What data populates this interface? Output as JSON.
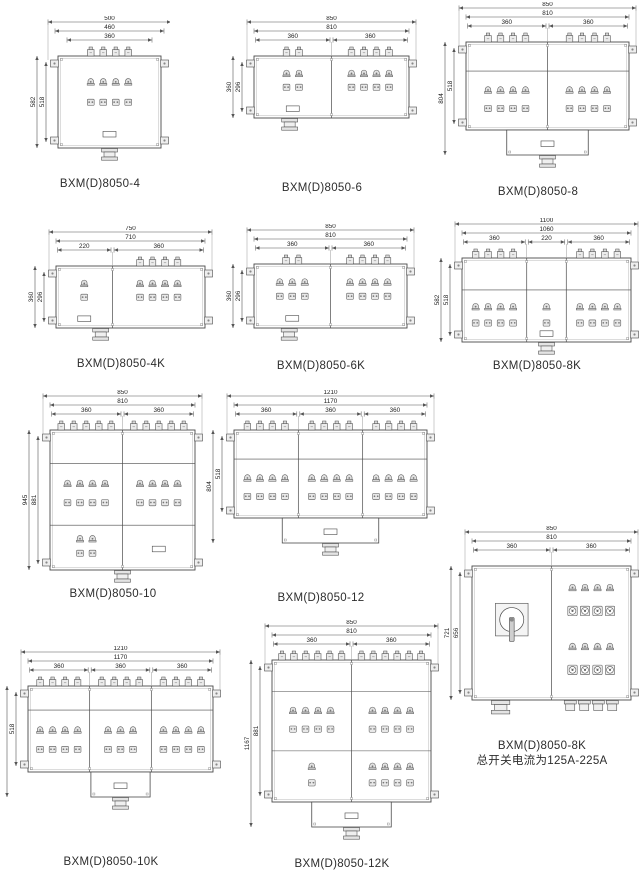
{
  "diagrams": [
    {
      "key": "d4",
      "caption": "BXM(D)8050-4",
      "note": "",
      "top_dims": [
        "500",
        "460",
        "360"
      ],
      "seg_dims": [],
      "side_dims": [
        "582",
        "518"
      ],
      "sections": [
        {
          "breakers": 4,
          "mid": [
            4,
            4
          ]
        }
      ],
      "features": {
        "bands": 0,
        "bottom_box": "none",
        "gland": true,
        "gland_at": "center",
        "nameplate_at": "center"
      }
    },
    {
      "key": "d6",
      "caption": "BXM(D)8050-6",
      "note": "",
      "top_dims": [
        "850",
        "810"
      ],
      "seg_dims": [
        "360",
        "360"
      ],
      "side_dims": [
        "360",
        "296"
      ],
      "sections": [
        {
          "breakers": 2,
          "mid": [
            2,
            2
          ]
        },
        {
          "breakers": 4,
          "mid": [
            4,
            4
          ]
        }
      ],
      "features": {
        "bands": 0,
        "bottom_box": "none",
        "gland": true,
        "gland_at": "left",
        "nameplate_at": "left"
      }
    },
    {
      "key": "d8",
      "caption": "BXM(D)8050-8",
      "note": "",
      "top_dims": [
        "850",
        "810"
      ],
      "seg_dims": [
        "360",
        "360"
      ],
      "side_dims": [
        "804",
        "518"
      ],
      "sections": [
        {
          "breakers": 4,
          "mid": [
            4,
            4
          ]
        },
        {
          "breakers": 4,
          "mid": [
            4,
            4
          ]
        }
      ],
      "features": {
        "bands": 1,
        "bottom_box": "wide",
        "gland": true,
        "gland_at": "center",
        "nameplate_at": "ext"
      }
    },
    {
      "key": "d4k",
      "caption": "BXM(D)8050-4K",
      "note": "",
      "top_dims": [
        "750",
        "710"
      ],
      "seg_dims": [
        "220",
        "360"
      ],
      "side_dims": [
        "360",
        "296"
      ],
      "sections": [
        {
          "breakers": 0,
          "mid": [
            1,
            1
          ]
        },
        {
          "breakers": 4,
          "mid": [
            4,
            4
          ]
        }
      ],
      "features": {
        "bands": 0,
        "bottom_box": "none",
        "gland": true,
        "gland_at": "leftmid",
        "nameplate_at": "left"
      }
    },
    {
      "key": "d6k",
      "caption": "BXM(D)8050-6K",
      "note": "",
      "top_dims": [
        "850",
        "810"
      ],
      "seg_dims": [
        "360",
        "360"
      ],
      "side_dims": [
        "360",
        "296"
      ],
      "sections": [
        {
          "breakers": 2,
          "mid": [
            3,
            3
          ]
        },
        {
          "breakers": 4,
          "mid": [
            4,
            4
          ]
        }
      ],
      "features": {
        "bands": 0,
        "bottom_box": "none",
        "gland": true,
        "gland_at": "left",
        "nameplate_at": "left"
      }
    },
    {
      "key": "d8k",
      "caption": "BXM(D)8050-8K",
      "note": "",
      "top_dims": [
        "1100",
        "1060"
      ],
      "seg_dims": [
        "360",
        "220",
        "360"
      ],
      "side_dims": [
        "582",
        "518"
      ],
      "sections": [
        {
          "breakers": 4,
          "mid": [
            4,
            4
          ]
        },
        {
          "breakers": 0,
          "mid": [
            1,
            1
          ]
        },
        {
          "breakers": 4,
          "mid": [
            4,
            4
          ]
        }
      ],
      "features": {
        "bands": 1,
        "bottom_box": "none",
        "gland": true,
        "gland_at": "center",
        "nameplate_at": "mid"
      }
    },
    {
      "key": "d10",
      "caption": "BXM(D)8050-10",
      "note": "",
      "top_dims": [
        "850",
        "810"
      ],
      "seg_dims": [
        "360",
        "360"
      ],
      "side_dims": [
        "945",
        "881"
      ],
      "sections": [
        {
          "breakers": 5,
          "mid": [
            4,
            4
          ],
          "bot": [
            2,
            2
          ]
        },
        {
          "breakers": 5,
          "mid": [
            4,
            4
          ]
        }
      ],
      "features": {
        "bands": 2,
        "bottom_box": "none",
        "gland": true,
        "gland_at": "center",
        "nameplate_at": "right"
      }
    },
    {
      "key": "d12",
      "caption": "BXM(D)8050-12",
      "note": "",
      "top_dims": [
        "1210",
        "1170"
      ],
      "seg_dims": [
        "360",
        "360",
        "360"
      ],
      "side_dims": [
        "804",
        "518"
      ],
      "sections": [
        {
          "breakers": 4,
          "mid": [
            4,
            4
          ]
        },
        {
          "breakers": 4,
          "mid": [
            4,
            4
          ]
        },
        {
          "breakers": 4,
          "mid": [
            4,
            4
          ]
        }
      ],
      "features": {
        "bands": 1,
        "bottom_box": "wide",
        "gland": true,
        "gland_at": "center",
        "nameplate_at": "ext"
      }
    },
    {
      "key": "d8kbig",
      "caption": "BXM(D)8050-8K",
      "note": "总开关电流为125A-225A",
      "top_dims": [
        "850",
        "810"
      ],
      "seg_dims": [
        "360",
        "360"
      ],
      "side_dims": [
        "721",
        "656"
      ],
      "sections": [
        {
          "type": "switch"
        },
        {
          "type": "groups",
          "groups": [
            [
              4,
              4
            ],
            [
              4,
              4
            ]
          ]
        }
      ],
      "features": {
        "bands": 0,
        "bottom_box": "none",
        "glands": "multi"
      }
    },
    {
      "key": "d10k",
      "caption": "BXM(D)8050-10K",
      "note": "",
      "top_dims": [
        "1210",
        "1170"
      ],
      "seg_dims": [
        "360",
        "360",
        "360"
      ],
      "side_dims": [
        "",
        "518"
      ],
      "sections": [
        {
          "breakers": 4,
          "mid": [
            4,
            4
          ]
        },
        {
          "breakers": 4,
          "mid": [
            3,
            3
          ]
        },
        {
          "breakers": 4,
          "mid": [
            4,
            4
          ]
        }
      ],
      "features": {
        "bands": 1,
        "bottom_box": "center",
        "gland": true,
        "gland_at": "center",
        "nameplate_at": "ext"
      }
    },
    {
      "key": "d12k",
      "caption": "BXM(D)8050-12K",
      "note": "",
      "top_dims": [
        "850",
        "810"
      ],
      "seg_dims": [
        "360",
        "360"
      ],
      "side_dims": [
        "1167",
        "881"
      ],
      "sections": [
        {
          "breakers": 6,
          "mid": [
            4,
            4
          ],
          "bot": [
            1,
            1
          ]
        },
        {
          "breakers": 6,
          "mid": [
            4,
            4
          ],
          "bot": [
            4,
            4
          ]
        }
      ],
      "features": {
        "bands": 2,
        "bottom_box": "wide",
        "gland": true,
        "gland_at": "center",
        "nameplate_at": "ext"
      }
    }
  ],
  "colors": {
    "line": "#4a4a4a",
    "dim_line": "#555555",
    "dim_text": "#222222",
    "glyph_fill": "#e8e8e8"
  }
}
